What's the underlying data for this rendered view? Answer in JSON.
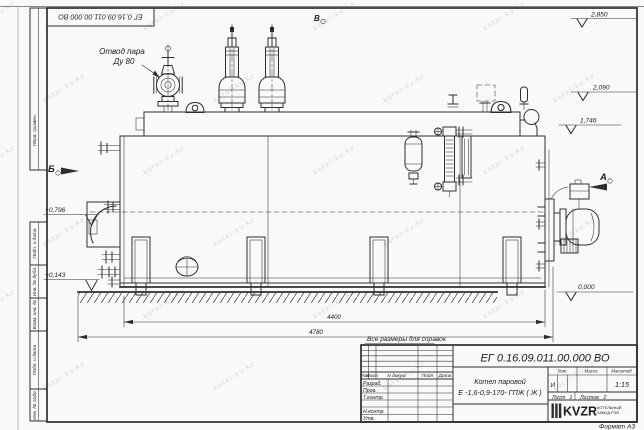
{
  "colors": {
    "paper": "#f9f9f7",
    "ink": "#2e2e2e",
    "watermark": "#b9bcc9"
  },
  "watermark": {
    "text": "kotel-kv.kz"
  },
  "frame": {
    "top_designation": "ЕГ 0.16.09.011.00.000  ВО",
    "side_labels": [
      "Перв. примен.",
      "Подп. и дата",
      "Инв. № дубл.",
      "Взам. инв. №",
      "Подп. и дата",
      "Инв. № подл."
    ],
    "format_label": "Формат А3"
  },
  "drawing": {
    "callout_line1": "Отвод пара",
    "callout_line2": "Ду 80",
    "view_b": "Б",
    "view_v": "В",
    "view_a": "А",
    "elev_2850": "2,850",
    "elev_2090": "2,090",
    "elev_1746": "1,746",
    "elev_0796": "+0,796",
    "elev_0143": "+0,143",
    "elev_0000": "0,000",
    "dim_4400": "4400",
    "dim_4780": "4780",
    "note": "Все размеры для справок"
  },
  "title_block": {
    "designation": "ЕГ 0.16.09.011.00.000  ВО",
    "name_line1": "Котел паровой",
    "name_line2": "Е -1,6-0,9-170- ГПЖ ( Ж )",
    "col_izm": "Изм",
    "col_list": "Лист",
    "col_doc": "N докум.",
    "col_podp": "Подп",
    "col_data": "Дата",
    "row_razrab": "Разраб.",
    "row_prov": "Пров.",
    "row_tkontr": "Т.контр.",
    "row_nkontr": "Н.контр.",
    "row_utv": "Утв.",
    "lit_label": "Лит.",
    "mass_label": "Масса",
    "scale_label": "Масштаб",
    "lit_value": "И",
    "scale_value": "1:15",
    "sheet_label": "Лист",
    "sheet_value": "1",
    "sheets_label": "Листов",
    "sheets_value": "2",
    "logo": "KVZR",
    "logo_sub1": "КОТЕЛЬНЫЙ",
    "logo_sub2": "ЗАВОД РЭП"
  }
}
